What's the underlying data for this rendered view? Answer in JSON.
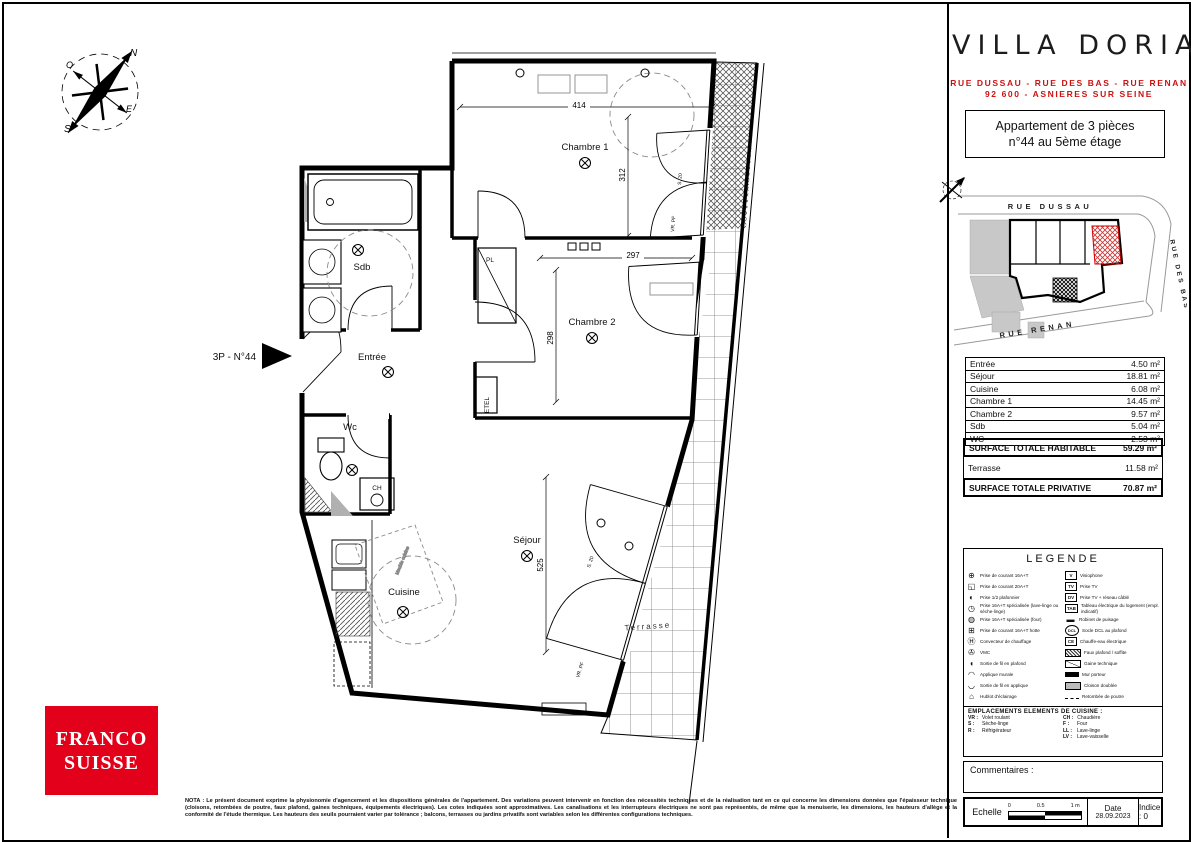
{
  "header": {
    "title": "VILLA DORIA",
    "address_line1": "RUE DUSSAU - RUE DES BAS - RUE RENAN",
    "address_line2": "92 600 - ASNIERES SUR SEINE"
  },
  "apartment_box": {
    "line1": "Appartement de 3 pièces",
    "line2": "n°44 au 5ème étage"
  },
  "site_plan": {
    "street_top": "RUE DUSSAU",
    "street_right": "RUE DES BAS",
    "street_bottom": "RUE RENAN"
  },
  "areas": {
    "rows": [
      {
        "name": "Entrée",
        "value": "4.50 m²"
      },
      {
        "name": "Séjour",
        "value": "18.81 m²"
      },
      {
        "name": "Cuisine",
        "value": "6.08 m²"
      },
      {
        "name": "Chambre 1",
        "value": "14.45 m²"
      },
      {
        "name": "Chambre 2",
        "value": "9.57 m²"
      },
      {
        "name": "Sdb",
        "value": "5.04 m²"
      },
      {
        "name": "WC",
        "value": "2.53 m²"
      }
    ],
    "total_habitable": {
      "name": "SURFACE TOTALE HABITABLE",
      "value": "59.29 m²"
    },
    "terrasse": {
      "name": "Terrasse",
      "value": "11.58 m²"
    },
    "total_privative": {
      "name": "SURFACE TOTALE PRIVATIVE",
      "value": "70.87 m²"
    }
  },
  "legend": {
    "title": "LEGENDE",
    "left": [
      {
        "glyph": "⊕",
        "label": "Prise de courant 16A+T"
      },
      {
        "glyph": "◱",
        "label": "Prise de courant 20A+T"
      },
      {
        "glyph": "◐",
        "label": "Prise 1/2 plafonnier"
      },
      {
        "glyph": "◷",
        "label": "Prise 16A+T spécialisée (lave-linge ou sèche-linge)"
      },
      {
        "glyph": "◍",
        "label": "Prise 16A+T spécialisée (four)"
      },
      {
        "glyph": "⊞",
        "label": "Prise de courant 16A+T hotte"
      },
      {
        "glyph": "Ⓗ",
        "label": "Convecteur de chauffage"
      },
      {
        "glyph": "✇",
        "label": "VMC"
      },
      {
        "glyph": "◖",
        "label": "Sortie de fil en plafond"
      },
      {
        "glyph": "◠",
        "label": "Applique murale"
      },
      {
        "glyph": "◡",
        "label": "Sortie de fil en applique"
      },
      {
        "glyph": "⌂",
        "label": "Hublot d'éclairage"
      }
    ],
    "right": [
      {
        "icon": "V",
        "label": "Visiophone"
      },
      {
        "icon": "TV",
        "label": "Prise TV"
      },
      {
        "icon": "DV",
        "label": "Prise TV + réseau câblé"
      },
      {
        "icon": "TAB",
        "label": "Tableau électrique du logement (empl. indicatif)"
      },
      {
        "icon": "▬",
        "label": "Robinet de puisage"
      },
      {
        "icon": "DCL",
        "label": "Socle DCL au plafond"
      },
      {
        "icon": "CE",
        "label": "Chauffe-eau électrique"
      },
      {
        "icon": "",
        "label": "Faux plafond / soffite"
      },
      {
        "icon": "",
        "label": "Gaine technique"
      },
      {
        "icon": "",
        "label": "Mur porteur"
      },
      {
        "icon": "",
        "label": "Cloison doublée"
      },
      {
        "icon": "",
        "label": "Retombée de poutre"
      }
    ],
    "kitchen_title": "EMPLACEMENTS ELEMENTS DE CUISINE :",
    "kitchen_left": [
      {
        "code": "VR :",
        "label": "Volet roulant"
      },
      {
        "code": "S :",
        "label": "Sèche-linge"
      },
      {
        "code": "R :",
        "label": "Réfrigérateur"
      }
    ],
    "kitchen_right": [
      {
        "code": "CH :",
        "label": "Chaudière"
      },
      {
        "code": "F :",
        "label": "Four"
      },
      {
        "code": "LL :",
        "label": "Lave-linge"
      },
      {
        "code": "LV :",
        "label": "Lave-vaisselle"
      }
    ]
  },
  "comments_label": "Commentaires :",
  "titleblock": {
    "scale_label": "Echelle",
    "tick0": "0",
    "tick05": "0.5",
    "tick1": "1 m",
    "date_label": "Date",
    "date": "28.09.2023",
    "index": "Indice : 0"
  },
  "logo": {
    "line1": "FRANCO",
    "line2": "SUISSE"
  },
  "nota": "NOTA : Le présent document exprime la physionomie d'agencement et les dispositions générales de l'appartement. Des variations peuvent intervenir en fonction des nécessités techniques et de la réalisation tant en ce qui concerne les dimensions données que l'épaisseur technique (cloisons, retombées de poutre, faux plafond, gaines techniques, équipements électriques). Les cotes indiquées sont approximatives. Les canalisations et les interrupteurs électriques ne sont pas représentés, de même que la menuiserie, les dimensions, les hauteurs d'allège et la conformité de l'étude thermique. Les hauteurs des seuils pourraient varier par tolérance ; balcons, terrasses ou jardins privatifs sont variables selon les différentes configurations techniques.",
  "plan": {
    "unit_label": "3P - N°44",
    "labels": {
      "ch1": "Chambre 1",
      "ch2": "Chambre 2",
      "sdb": "Sdb",
      "entree": "Entrée",
      "wc": "Wc",
      "sejour": "Séjour",
      "cuisine": "Cuisine",
      "terrasse": "Terrasse",
      "pl": "PL",
      "etel": "ETEL",
      "ch": "CH",
      "meuble": "Meuble cuisine"
    },
    "dims": {
      "ch1_w": "414",
      "ch1_h": "312",
      "ch2_w": "297",
      "ch2_h": "298",
      "sejour_h": "525",
      "s20_a": "S. 20",
      "s20_b": "S. 20",
      "vrpf_a": "VR. PF",
      "vrpf_b": "VR. PF"
    },
    "compass": {
      "n": "N",
      "e": "E",
      "s": "S",
      "o": "O"
    }
  },
  "colors": {
    "accent_red": "#c11111",
    "logo_red": "#e2001a"
  }
}
